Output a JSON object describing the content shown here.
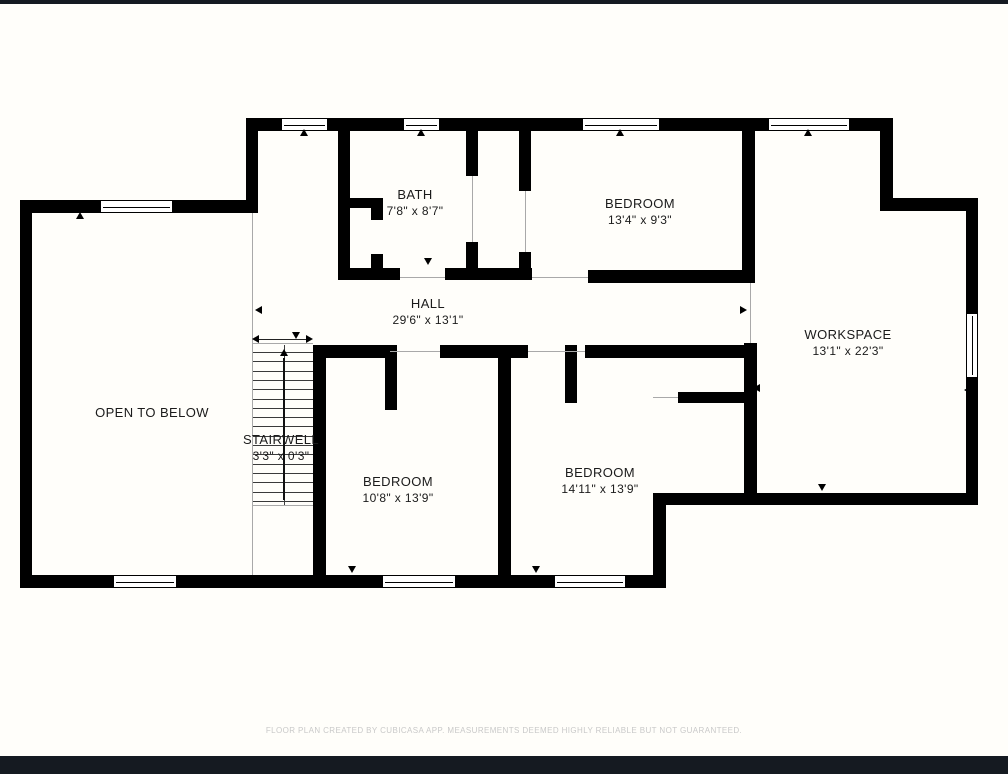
{
  "page": {
    "background": "#fffefa",
    "top_bar": {
      "color": "#151a21",
      "y": 0,
      "height": 4
    },
    "bottom_bar": {
      "color": "#151a21",
      "y": 756,
      "height": 18
    },
    "footer": {
      "text": "FLOOR PLAN CREATED BY CUBICASA APP. MEASUREMENTS DEEMED HIGHLY RELIABLE BUT NOT GUARANTEED.",
      "color": "#c9c9c9"
    }
  },
  "floorplan": {
    "wall_color": "#000000",
    "thin_line_color": "#a9a9a9",
    "label_color": "#1b1b1b",
    "rooms": [
      {
        "id": "bath",
        "name": "BATH",
        "dims": "7'8\" x 8'7\"",
        "cx": 415,
        "cy": 203
      },
      {
        "id": "bedroom-top",
        "name": "BEDROOM",
        "dims": "13'4\" x 9'3\"",
        "cx": 640,
        "cy": 212
      },
      {
        "id": "hall",
        "name": "HALL",
        "dims": "29'6\" x 13'1\"",
        "cx": 428,
        "cy": 312
      },
      {
        "id": "workspace",
        "name": "WORKSPACE",
        "dims": "13'1\" x 22'3\"",
        "cx": 848,
        "cy": 343
      },
      {
        "id": "open-to-below",
        "name": "OPEN TO BELOW",
        "dims": "",
        "cx": 152,
        "cy": 413
      },
      {
        "id": "stairwell",
        "name": "STAIRWELL",
        "dims": "3'3\" x 0'3\"",
        "cx": 281,
        "cy": 448
      },
      {
        "id": "bedroom-left",
        "name": "BEDROOM",
        "dims": "10'8\" x 13'9\"",
        "cx": 398,
        "cy": 490
      },
      {
        "id": "bedroom-right",
        "name": "BEDROOM",
        "dims": "14'11\" x 13'9\"",
        "cx": 600,
        "cy": 481
      }
    ],
    "walls": [
      [
        246,
        118,
        647,
        13
      ],
      [
        246,
        118,
        12,
        95
      ],
      [
        20,
        200,
        238,
        13
      ],
      [
        20,
        200,
        12,
        388
      ],
      [
        20,
        575,
        646,
        13
      ],
      [
        653,
        493,
        13,
        95
      ],
      [
        653,
        493,
        325,
        12
      ],
      [
        966,
        198,
        12,
        307
      ],
      [
        886,
        198,
        92,
        13
      ],
      [
        880,
        118,
        13,
        93
      ],
      [
        338,
        131,
        12,
        149
      ],
      [
        338,
        198,
        45,
        10
      ],
      [
        371,
        198,
        12,
        22
      ],
      [
        371,
        254,
        12,
        26
      ],
      [
        338,
        268,
        62,
        12
      ],
      [
        445,
        268,
        87,
        12
      ],
      [
        466,
        131,
        12,
        45
      ],
      [
        466,
        242,
        12,
        38
      ],
      [
        519,
        131,
        12,
        60
      ],
      [
        519,
        252,
        12,
        28
      ],
      [
        588,
        270,
        165,
        13
      ],
      [
        742,
        118,
        13,
        165
      ],
      [
        744,
        343,
        13,
        162
      ],
      [
        313,
        345,
        13,
        243
      ],
      [
        498,
        345,
        13,
        243
      ],
      [
        313,
        345,
        77,
        13
      ],
      [
        440,
        345,
        88,
        13
      ],
      [
        585,
        345,
        168,
        13
      ],
      [
        385,
        345,
        12,
        65
      ],
      [
        565,
        345,
        12,
        58
      ],
      [
        678,
        392,
        75,
        11
      ]
    ],
    "windows": [
      [
        281,
        118,
        47,
        13
      ],
      [
        403,
        118,
        37,
        13
      ],
      [
        582,
        118,
        78,
        13
      ],
      [
        768,
        118,
        82,
        13
      ],
      [
        100,
        200,
        73,
        13
      ],
      [
        113,
        575,
        64,
        13
      ],
      [
        382,
        575,
        74,
        13
      ],
      [
        554,
        575,
        72,
        13
      ],
      [
        966,
        313,
        12,
        65
      ]
    ],
    "thin_lines": [
      [
        252,
        213,
        1,
        362
      ],
      [
        252,
        343,
        61,
        1
      ],
      [
        253,
        505,
        60,
        1
      ],
      [
        400,
        277,
        45,
        1
      ],
      [
        532,
        277,
        56,
        1
      ],
      [
        472,
        176,
        1,
        66
      ],
      [
        525,
        191,
        1,
        61
      ],
      [
        750,
        283,
        1,
        60
      ],
      [
        390,
        351,
        50,
        1
      ],
      [
        528,
        351,
        57,
        1
      ],
      [
        653,
        397,
        25,
        1
      ]
    ],
    "stairs": {
      "x": 253,
      "y": 345,
      "w": 60,
      "h": 160,
      "treads": 17,
      "tread_top": 352,
      "tread_step": 9.3,
      "stringer_x": 284,
      "arrow_x": 283,
      "arrow_top": 358,
      "arrow_bottom": 500,
      "measure_y": 339,
      "measure_x1": 256,
      "measure_x2": 310
    },
    "markers": [
      {
        "x": 304,
        "y": 133,
        "dir": "up"
      },
      {
        "x": 421,
        "y": 133,
        "dir": "up"
      },
      {
        "x": 620,
        "y": 133,
        "dir": "up"
      },
      {
        "x": 808,
        "y": 133,
        "dir": "up"
      },
      {
        "x": 80,
        "y": 216,
        "dir": "up"
      },
      {
        "x": 352,
        "y": 570,
        "dir": "down"
      },
      {
        "x": 536,
        "y": 570,
        "dir": "down"
      },
      {
        "x": 259,
        "y": 310,
        "dir": "left"
      },
      {
        "x": 744,
        "y": 310,
        "dir": "right"
      },
      {
        "x": 428,
        "y": 262,
        "dir": "down"
      },
      {
        "x": 822,
        "y": 488,
        "dir": "down"
      },
      {
        "x": 470,
        "y": 160,
        "dir": "right"
      },
      {
        "x": 525,
        "y": 186,
        "dir": "down"
      },
      {
        "x": 757,
        "y": 388,
        "dir": "left"
      },
      {
        "x": 751,
        "y": 444,
        "dir": "right"
      },
      {
        "x": 968,
        "y": 390,
        "dir": "left"
      }
    ]
  }
}
